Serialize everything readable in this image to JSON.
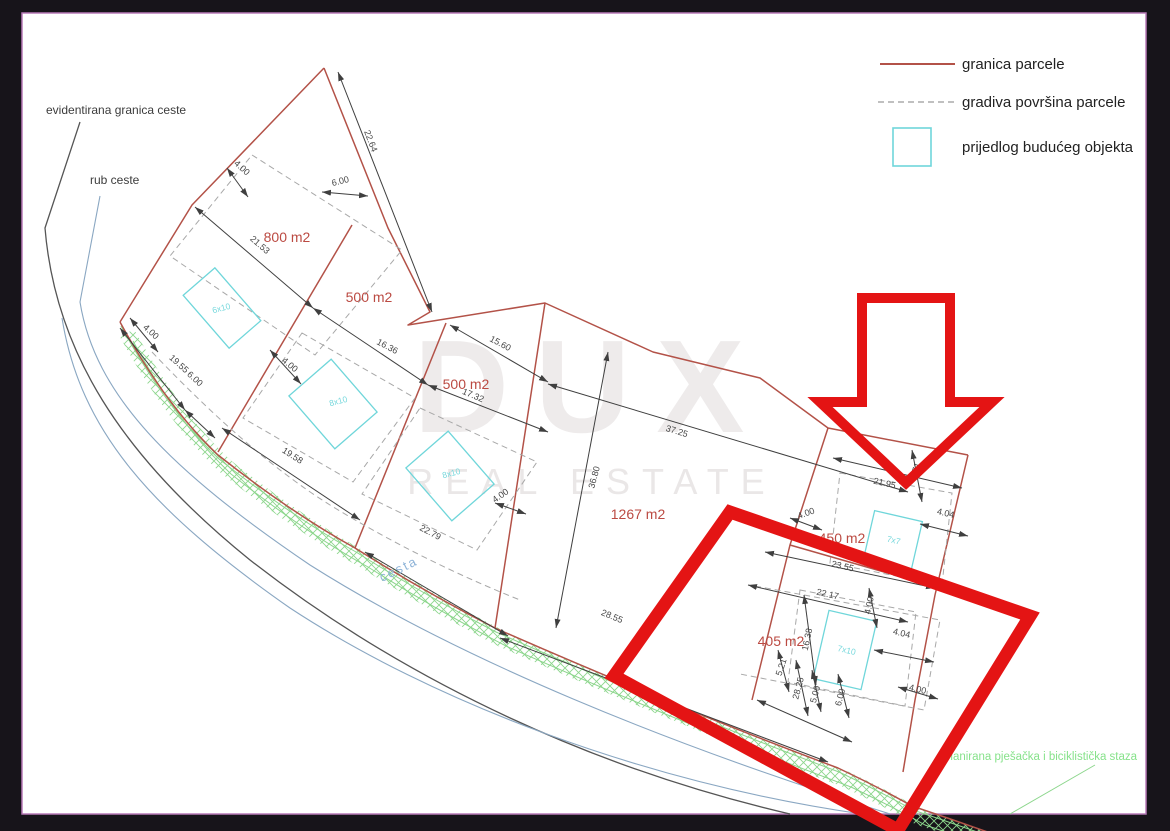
{
  "window": {
    "background": "#17141a",
    "paper_border": "#b87ab8"
  },
  "legend": {
    "items": [
      {
        "symbol": "solid-red-line",
        "label": "granica parcele"
      },
      {
        "symbol": "dashed-gray-line",
        "label": "gradiva površina parcele"
      },
      {
        "symbol": "cyan-square",
        "label": "prijedlog budućeg objekta"
      }
    ]
  },
  "watermark": {
    "line1": "DUX",
    "line2": "REAL ESTATE"
  },
  "callouts": {
    "road_boundary": "evidentirana granica ceste",
    "road_edge": "rub ceste",
    "road_name": "cesta",
    "path_label": "planirana pješačka i biciklistička staza"
  },
  "parcels": [
    {
      "area": "800 m2",
      "building": "6x10"
    },
    {
      "area": "500 m2",
      "building": "8x10"
    },
    {
      "area": "500 m2",
      "building": "8x10"
    },
    {
      "area": "1267 m2",
      "building": ""
    },
    {
      "area": "450 m2",
      "building": "7x7"
    },
    {
      "area": "405 m2",
      "building": "7x10"
    }
  ],
  "dimensions": [
    {
      "text": "22.64",
      "x": 368,
      "y": 142,
      "r": 69
    },
    {
      "text": "4.00",
      "x": 240,
      "y": 170,
      "r": 42
    },
    {
      "text": "6.00",
      "x": 341,
      "y": 184,
      "r": -14
    },
    {
      "text": "21.53",
      "x": 258,
      "y": 247,
      "r": 41
    },
    {
      "text": "16.36",
      "x": 386,
      "y": 349,
      "r": 28
    },
    {
      "text": "15.60",
      "x": 499,
      "y": 346,
      "r": 28
    },
    {
      "text": "17.32",
      "x": 472,
      "y": 398,
      "r": 23
    },
    {
      "text": "37.25",
      "x": 676,
      "y": 434,
      "r": 17
    },
    {
      "text": "36.80",
      "x": 597,
      "y": 478,
      "r": -75
    },
    {
      "text": "4.00",
      "x": 149,
      "y": 334,
      "r": 42
    },
    {
      "text": "19.55",
      "x": 177,
      "y": 366,
      "r": 42
    },
    {
      "text": "6.00",
      "x": 193,
      "y": 381,
      "r": 42
    },
    {
      "text": "19.58",
      "x": 291,
      "y": 458,
      "r": 33
    },
    {
      "text": "4.00",
      "x": 288,
      "y": 367,
      "r": 40
    },
    {
      "text": "4.00",
      "x": 502,
      "y": 498,
      "r": -35
    },
    {
      "text": "22.79",
      "x": 429,
      "y": 535,
      "r": 28
    },
    {
      "text": "28.55",
      "x": 611,
      "y": 619,
      "r": 22
    },
    {
      "text": "4.00",
      "x": 807,
      "y": 516,
      "r": -20
    },
    {
      "text": "21.95",
      "x": 884,
      "y": 486,
      "r": 13
    },
    {
      "text": "3.71",
      "x": 918,
      "y": 472,
      "r": -72
    },
    {
      "text": "4.04",
      "x": 945,
      "y": 516,
      "r": 13
    },
    {
      "text": "23.55",
      "x": 842,
      "y": 569,
      "r": 13
    },
    {
      "text": "22.17",
      "x": 827,
      "y": 597,
      "r": 13
    },
    {
      "text": "4.00",
      "x": 872,
      "y": 606,
      "r": -78
    },
    {
      "text": "4.04",
      "x": 901,
      "y": 636,
      "r": 13
    },
    {
      "text": "16.38",
      "x": 810,
      "y": 640,
      "r": -78
    },
    {
      "text": "5.21",
      "x": 784,
      "y": 668,
      "r": -72
    },
    {
      "text": "28.25",
      "x": 801,
      "y": 689,
      "r": -75
    },
    {
      "text": "5.00",
      "x": 818,
      "y": 695,
      "r": -75
    },
    {
      "text": "6.00",
      "x": 843,
      "y": 698,
      "r": -75
    },
    {
      "text": "4.00",
      "x": 917,
      "y": 692,
      "r": 13
    }
  ],
  "colors": {
    "parcel_line": "#b35248",
    "highlight": "#e41414",
    "building": "#6fd6da",
    "hatch_green": "#8cd68c",
    "road_edge_blue": "#8aa7c2",
    "dimension": "#3f3f3f",
    "area_label": "#bb4a42",
    "path_green": "#86e28a",
    "road_name_blue": "#8fb4d8"
  }
}
